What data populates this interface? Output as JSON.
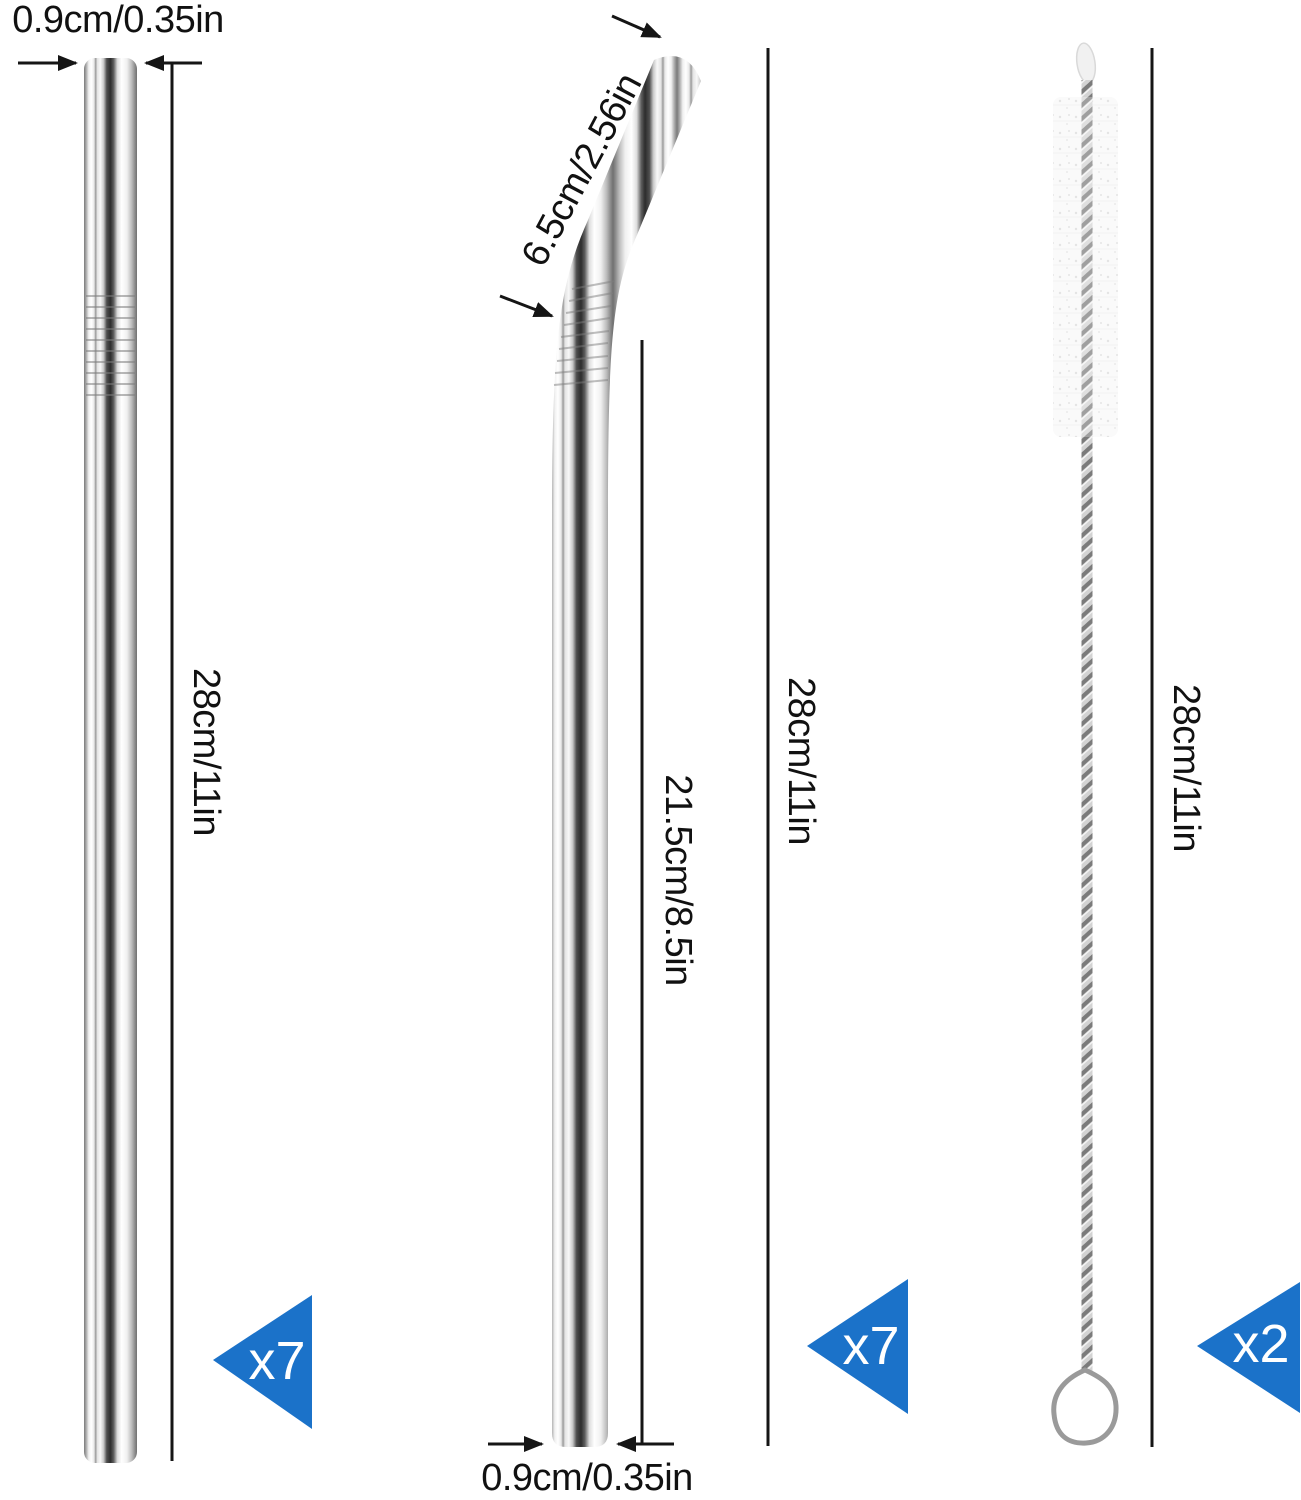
{
  "straight_straw": {
    "diameter_label": "0.9cm/0.35in",
    "length_label": "28cm/11in",
    "count_badge": "x7"
  },
  "bent_straw": {
    "bend_length_label": "6.5cm/2.56in",
    "straight_section_label": "21.5cm/8.5in",
    "total_length_label": "28cm/11in",
    "diameter_label": "0.9cm/0.35in",
    "count_badge": "x7"
  },
  "cleaning_brush": {
    "length_label": "28cm/11in",
    "count_badge": "x2"
  },
  "colors": {
    "badge_blue": "#1b72c9",
    "dimension_line": "#151515",
    "label_text": "#111111"
  }
}
